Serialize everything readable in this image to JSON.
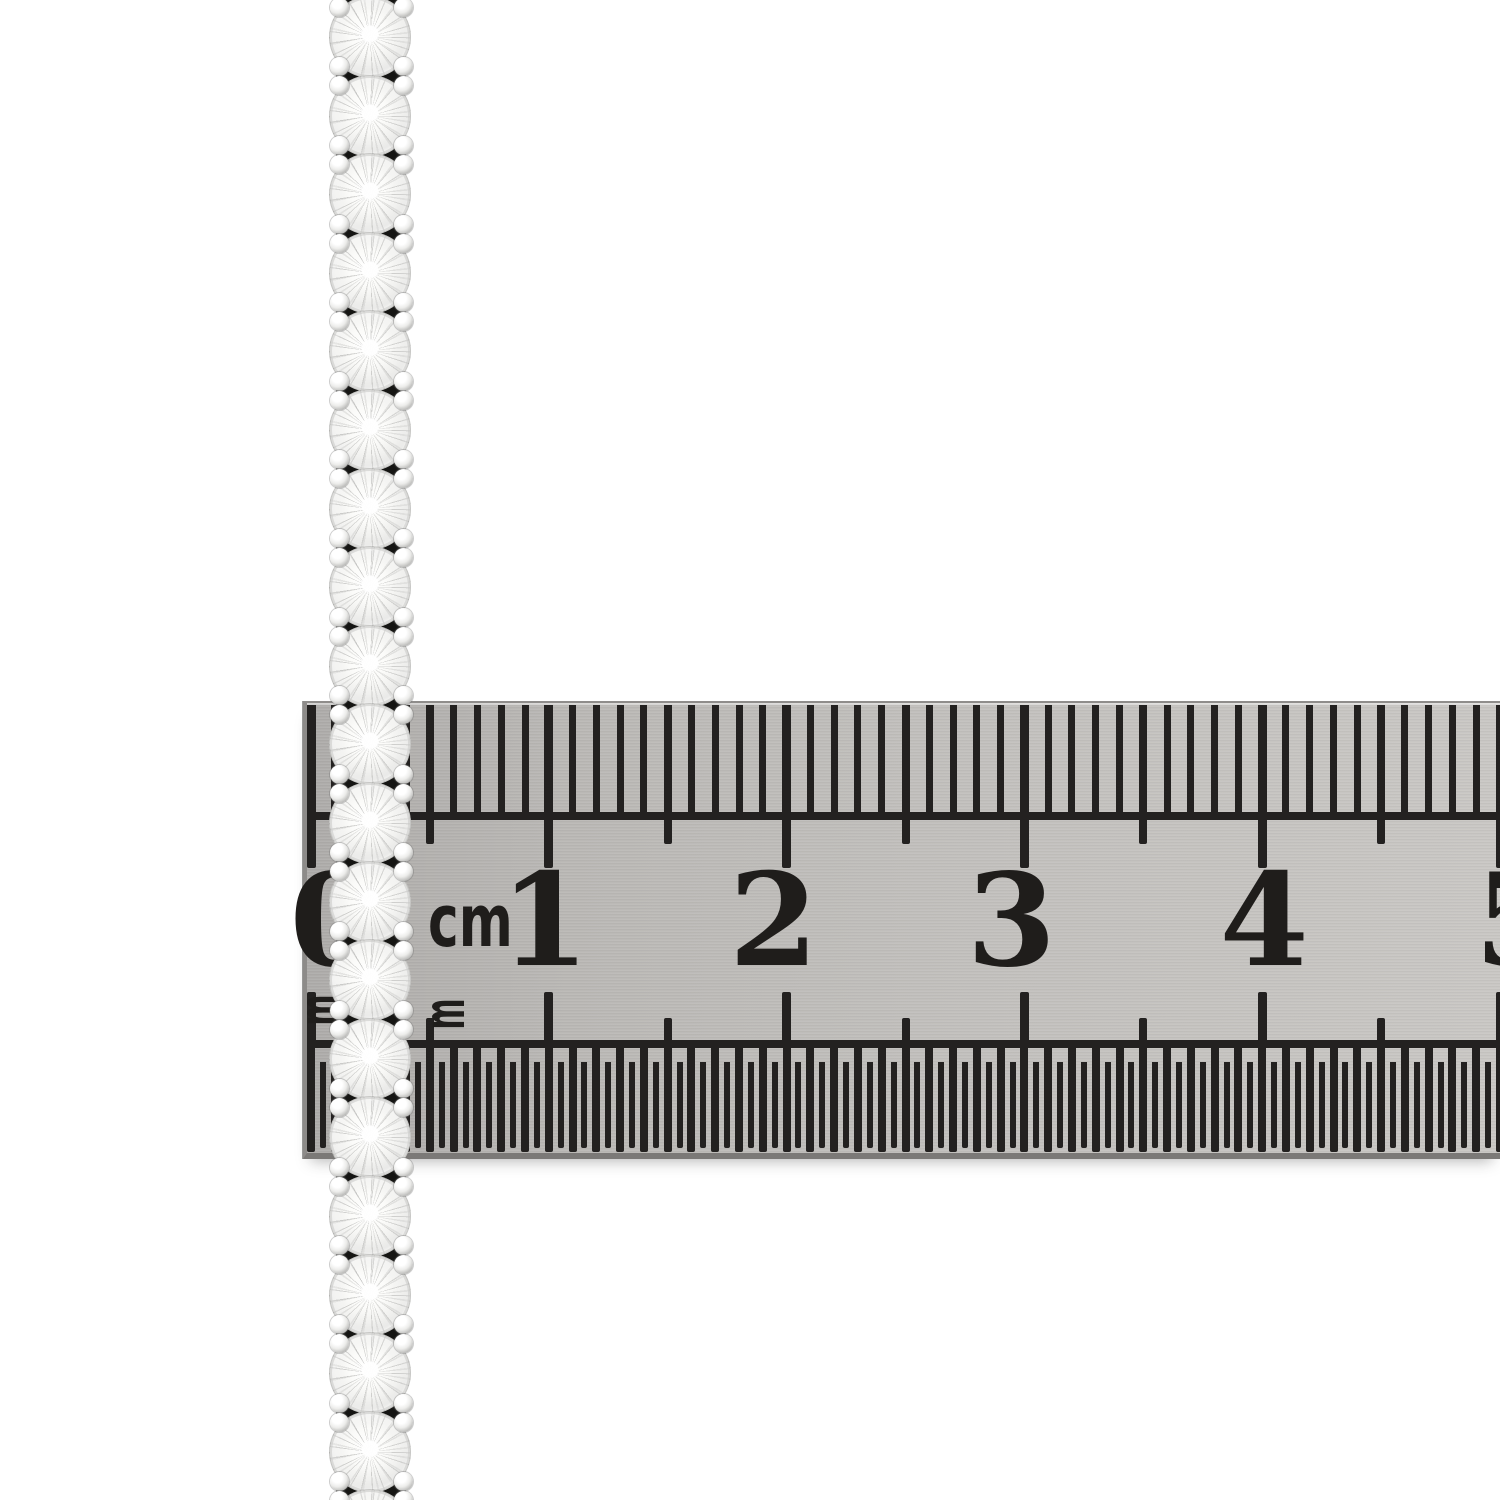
{
  "scene": {
    "subject": "diamond tennis necklace measured against a steel ruler",
    "background_color": "#ffffff",
    "photo_note": "vertical strand of round brilliant-cut diamonds in four-prong settings, brushed-steel ruler laid horizontally across it"
  },
  "necklace": {
    "geometry": {
      "left": 325,
      "top": 0,
      "width": 92,
      "height": 1500,
      "first_stone_cy": 37,
      "stone_pitch": 78.6,
      "stone_count": 20,
      "stone_diameter": 82,
      "prong_diameter": 19,
      "prong_x_centers": [
        14,
        78
      ],
      "junction_offset": 39.3
    },
    "colors": {
      "stone": "#f7f7f5",
      "prong_metal": "#c7c7c5",
      "gap_shadow": "#1d1d1b"
    }
  },
  "ruler": {
    "geometry": {
      "left": 303,
      "top": 701,
      "width": 1197,
      "height": 458,
      "origin_x": 4,
      "cm_px": 237.8,
      "mm_px": 23.78,
      "half_mm_px": 11.89,
      "number_offsets": [
        23,
        -4,
        -13,
        -13,
        2,
        19
      ]
    },
    "colors": {
      "face_left": "#aeacaa",
      "face_mid": "#c2c0bd",
      "face_right": "#c9c7c4",
      "tick": "#232120",
      "edge_top": "#8f8d8b",
      "edge_bottom": "#7b7977"
    },
    "top_scale": {
      "unit_label": "cm",
      "numbers": [
        0,
        1,
        2,
        3,
        4,
        5
      ],
      "mm_tick_len": 111,
      "half_cm_tick_len": 139,
      "cm_tick_len": 163,
      "baseline_y": 109,
      "number_top": 154,
      "number_font_px": 128,
      "cm_label_pos": {
        "x": 121,
        "y": 182
      },
      "cm_label_font_px": 72
    },
    "bottom_scale": {
      "unit_label": "m",
      "line_y": 337,
      "cm_up_len": 56,
      "half_cm_up_len": 30,
      "mm_down_len": 104,
      "half_mm_down_len": 86,
      "label_font_px": 30,
      "label_positions": [
        {
          "x": 140,
          "y": 311
        },
        {
          "x": 15,
          "y": 307
        }
      ]
    }
  }
}
